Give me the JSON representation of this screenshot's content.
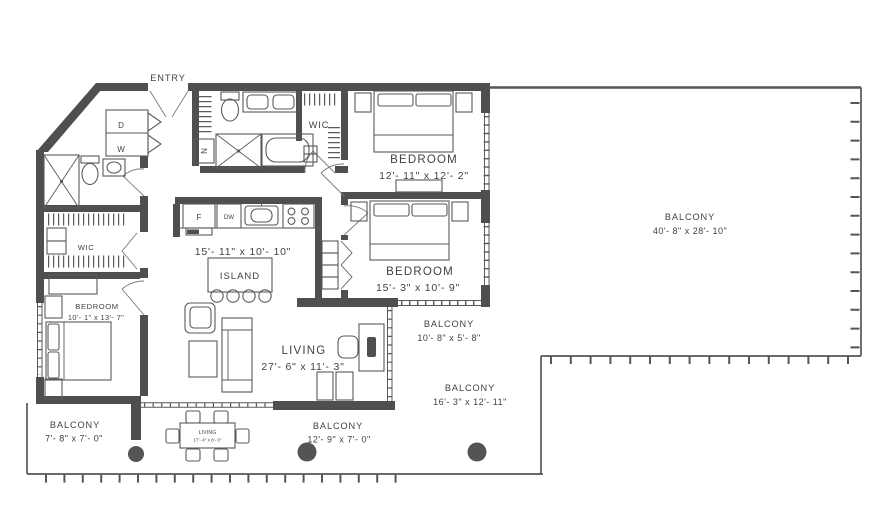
{
  "plan_title": "2 bedroom + den floor plan",
  "entry": {
    "label": "ENTRY"
  },
  "laundry": {
    "dryer": "D",
    "washer": "W"
  },
  "closets": {
    "wic1": "WIC",
    "wic2": "WIC",
    "linen": "N"
  },
  "kitchen": {
    "dims": "15'- 11\" x 10'- 10\"",
    "island": "ISLAND",
    "fridge": "F",
    "dishwasher": "DW"
  },
  "rooms": {
    "bedroom1": {
      "name": "BEDROOM",
      "dims": "12'- 11\" x 12'- 2\""
    },
    "bedroom2": {
      "name": "BEDROOM",
      "dims": "15'- 3\" x 10'- 9\""
    },
    "bedroom3": {
      "name": "BEDROOM",
      "dims": "10'- 1\" x 13'- 7\""
    },
    "living": {
      "name": "LIVING",
      "dims": "27'- 6\" x 11'- 3\""
    },
    "dining_table": {
      "name": "LIVING",
      "dims": "17'- 4\" x 8'- 0\""
    }
  },
  "balconies": {
    "large": {
      "name": "BALCONY",
      "dims": "40'- 8\" x 28'- 10\""
    },
    "mid": {
      "name": "BALCONY",
      "dims": "10'- 8\" x 5'- 8\""
    },
    "lower": {
      "name": "BALCONY",
      "dims": "16'- 3\" x 12'- 11\""
    },
    "bottom": {
      "name": "BALCONY",
      "dims": "12'- 9\" x 7'- 0\""
    },
    "left": {
      "name": "BALCONY",
      "dims": "7'- 8\" x 7'- 0\""
    }
  },
  "colors": {
    "wall": "#4f4f4f",
    "line": "#5a5a5a",
    "text": "#424242"
  }
}
